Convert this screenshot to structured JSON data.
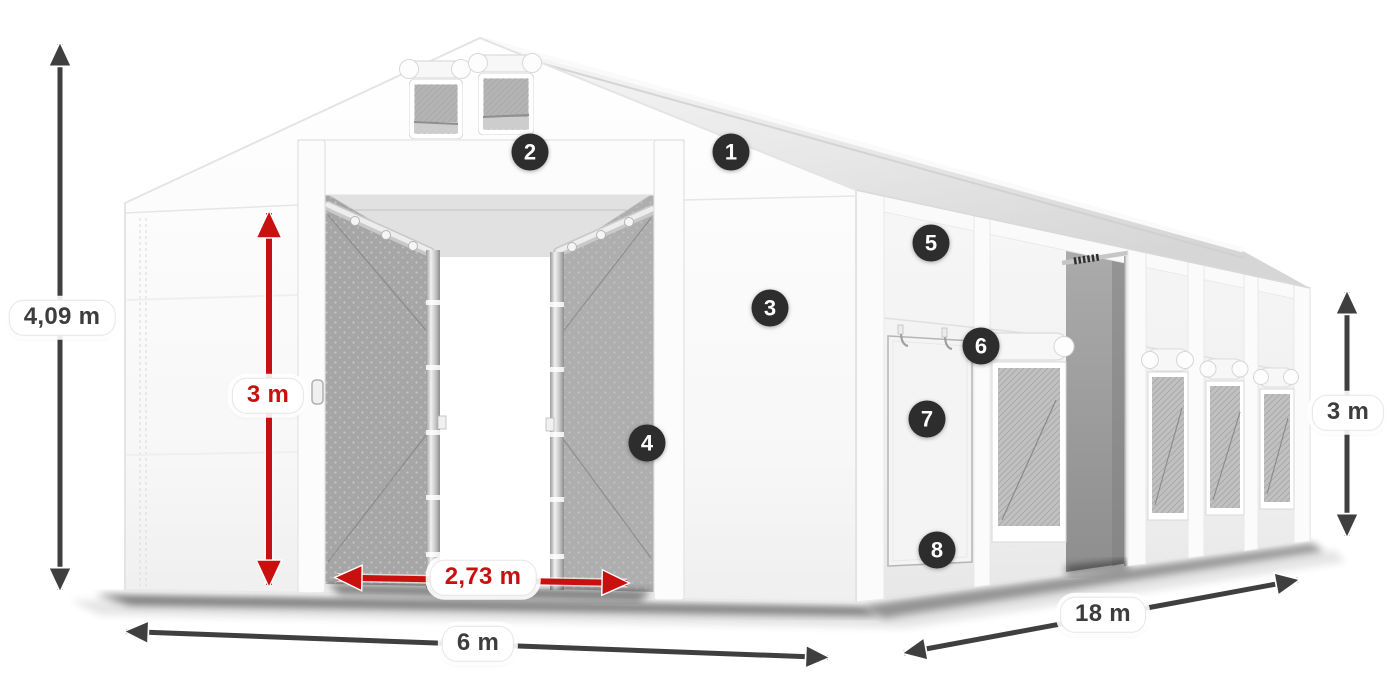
{
  "colors": {
    "arrow_dark": "#3f3f3f",
    "arrow_red": "#c8100f",
    "badge_bg": "#2d2d2d",
    "badge_text": "#ffffff",
    "pill_bg": "#ffffff",
    "pill_text_dark": "#3d3d3d",
    "pill_text_red": "#c8100f"
  },
  "dimensions": {
    "total_height": "4,09 m",
    "interior_height": "3 m",
    "entrance_width": "2,73 m",
    "width": "6 m",
    "length": "18 m",
    "side_height": "3 m"
  },
  "callouts": [
    {
      "label": "1"
    },
    {
      "label": "2"
    },
    {
      "label": "3"
    },
    {
      "label": "4"
    },
    {
      "label": "5"
    },
    {
      "label": "6"
    },
    {
      "label": "7"
    },
    {
      "label": "8"
    }
  ]
}
